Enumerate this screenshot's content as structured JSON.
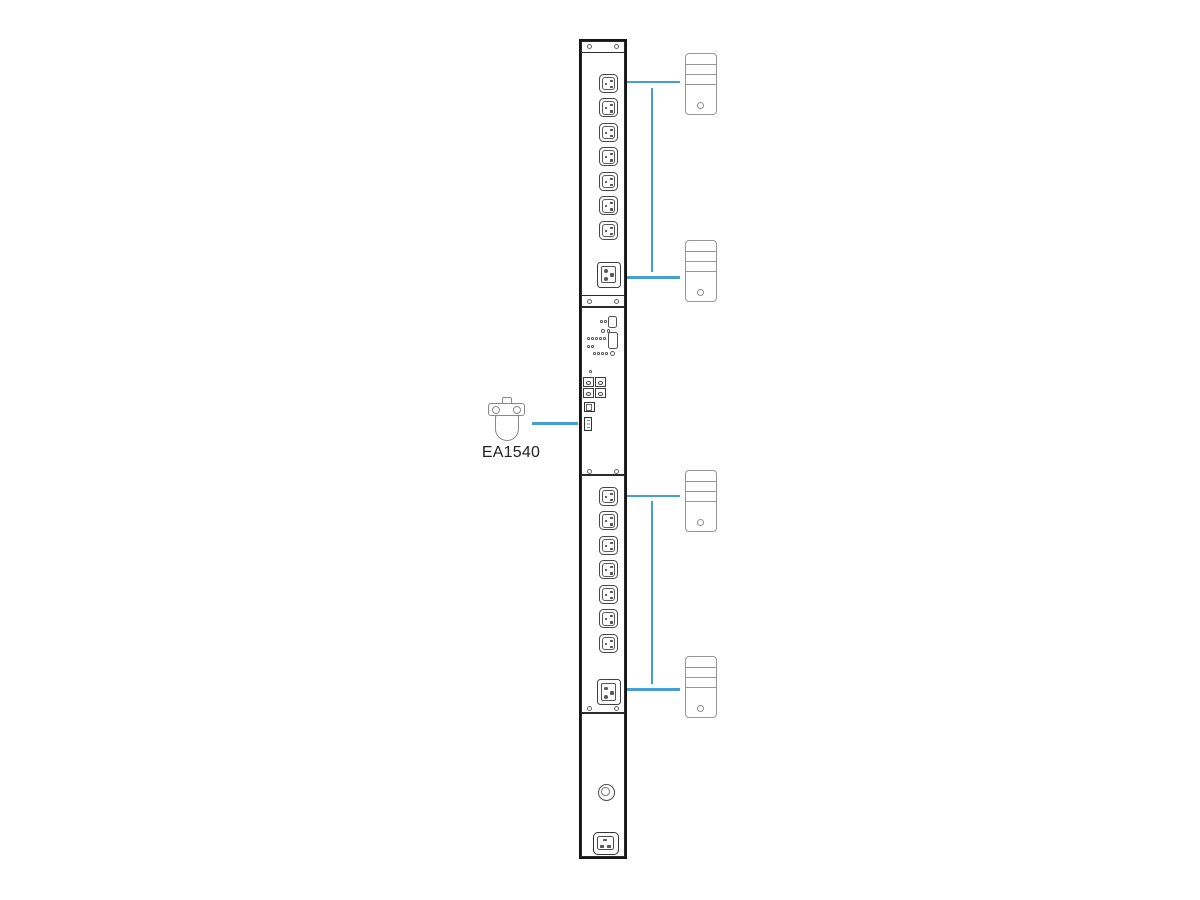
{
  "diagram": {
    "background_color": "#ffffff",
    "accent_color": "#449fd2",
    "pdu": {
      "frame_color": "#151515",
      "outlet_banks": [
        {
          "position": "top",
          "c13_outlets": 7,
          "c19_outlets": 1
        },
        {
          "position": "bottom",
          "c13_outlets": 7,
          "c19_outlets": 1
        }
      ],
      "control_panel": {
        "buttons": 2,
        "status_leds": 16,
        "combo_ports": 4,
        "lan_ports": 1,
        "sensor_ports": 1
      },
      "reset_buttons": 1,
      "power_inlets": 1
    },
    "sensor": {
      "label": "EA1540"
    },
    "servers": {
      "count": 4
    }
  }
}
